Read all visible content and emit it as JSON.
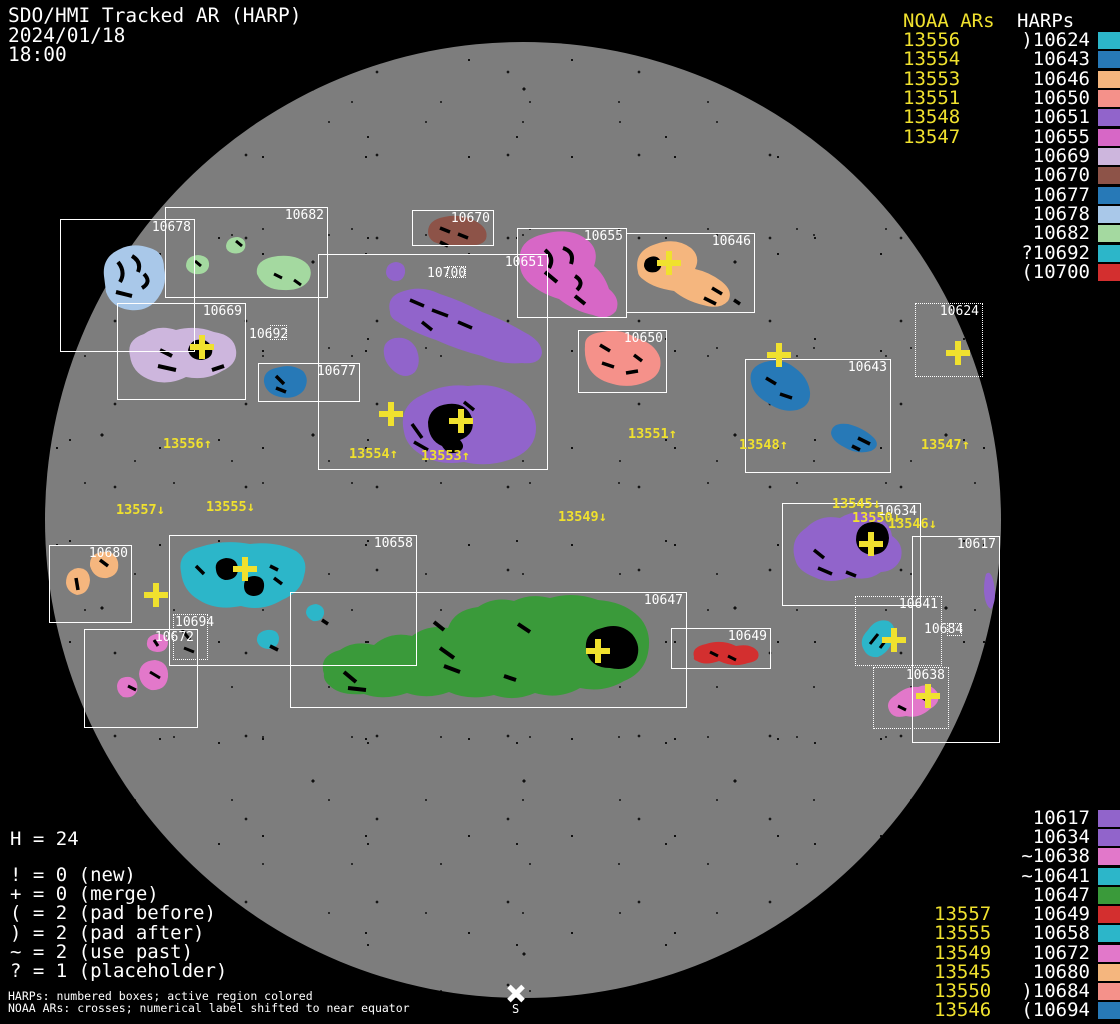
{
  "colors": {
    "yellow": "#f0e12e",
    "disk": "#7d7d7d",
    "background": "#000000",
    "box_outline": "#ffffff"
  },
  "header": {
    "title": "SDO/HMI Tracked AR (HARP)",
    "date": "2024/01/18",
    "time": "18:00"
  },
  "legend_top": {
    "noaa_header": "NOAA ARs",
    "harp_header": "HARPs",
    "rows": [
      {
        "noaa": "13556",
        "harp": ")10624",
        "color": "#2cb6c9"
      },
      {
        "noaa": "13554",
        "harp": "10643",
        "color": "#2779b7"
      },
      {
        "noaa": "13553",
        "harp": "10646",
        "color": "#f5b67e"
      },
      {
        "noaa": "13551",
        "harp": "10650",
        "color": "#f5918a"
      },
      {
        "noaa": "13548",
        "harp": "10651",
        "color": "#9164cb"
      },
      {
        "noaa": "13547",
        "harp": "10655",
        "color": "#d767c6"
      },
      {
        "noaa": "",
        "harp": "10669",
        "color": "#cdb6dd"
      },
      {
        "noaa": "",
        "harp": "10670",
        "color": "#8d5348"
      },
      {
        "noaa": "",
        "harp": "10677",
        "color": "#2779b7"
      },
      {
        "noaa": "",
        "harp": "10678",
        "color": "#a9c8e9"
      },
      {
        "noaa": "",
        "harp": "10682",
        "color": "#a4d9a0"
      },
      {
        "noaa": "",
        "harp": "?10692",
        "color": "#2cb6c9"
      },
      {
        "noaa": "",
        "harp": "(10700",
        "color": "#d32f2f"
      }
    ]
  },
  "legend_bottom": {
    "rows": [
      {
        "noaa": "",
        "harp": "10617",
        "color": "#9164cb"
      },
      {
        "noaa": "",
        "harp": "10634",
        "color": "#9164cb"
      },
      {
        "noaa": "",
        "harp": "~10638",
        "color": "#e278ca"
      },
      {
        "noaa": "",
        "harp": "~10641",
        "color": "#2cb6c9"
      },
      {
        "noaa": "",
        "harp": "10647",
        "color": "#3a9a3a"
      },
      {
        "noaa": "13557",
        "harp": "10649",
        "color": "#d32f2f"
      },
      {
        "noaa": "13555",
        "harp": "10658",
        "color": "#2cb6c9"
      },
      {
        "noaa": "13549",
        "harp": "10672",
        "color": "#e278ca"
      },
      {
        "noaa": "13545",
        "harp": "10680",
        "color": "#f5b67e"
      },
      {
        "noaa": "13550",
        "harp": ")10684",
        "color": "#f5918a"
      },
      {
        "noaa": "13546",
        "harp": "(10694",
        "color": "#2779b7"
      }
    ]
  },
  "stats": {
    "harp_count": "H = 24",
    "lines": [
      "! = 0 (new)",
      "+ = 0 (merge)",
      "( = 2 (pad before)",
      ") = 2 (pad after)",
      "~ = 2 (use past)",
      "? = 1 (placeholder)"
    ]
  },
  "caption": {
    "line1": "HARPs: numbered boxes; active region colored",
    "line2": "NOAA ARs: crosses; numerical label shifted to near equator"
  },
  "south_marker": {
    "label": "S"
  },
  "map_labels": {
    "l13556": "13556↑",
    "l13554": "13554↑",
    "l13553": "13553↑",
    "l13551": "13551↑",
    "l13548": "13548↑",
    "l13547": "13547↑",
    "l13557": "13557↓",
    "l13555": "13555↓",
    "l13549": "13549↓",
    "l13545": "13545↓",
    "l13550": "13550↓",
    "l13546": "13546↓"
  },
  "harps": {
    "h10617": {
      "label": "10617",
      "color": "#9164cb"
    },
    "h10624": {
      "label": "10624",
      "color": "#2cb6c9"
    },
    "h10634": {
      "label": "10634",
      "color": "#9164cb"
    },
    "h10638": {
      "label": "10638",
      "color": "#e278ca"
    },
    "h10641": {
      "label": "10641",
      "color": "#2cb6c9"
    },
    "h10643": {
      "label": "10643",
      "color": "#2779b7"
    },
    "h10646": {
      "label": "10646",
      "color": "#f5b67e"
    },
    "h10647": {
      "label": "10647",
      "color": "#3a9a3a"
    },
    "h10649": {
      "label": "10649",
      "color": "#d32f2f"
    },
    "h10650": {
      "label": "10650",
      "color": "#f5918a"
    },
    "h10651": {
      "label": "10651",
      "color": "#9164cb"
    },
    "h10655": {
      "label": "10655",
      "color": "#d767c6"
    },
    "h10658": {
      "label": "10658",
      "color": "#2cb6c9"
    },
    "h10669": {
      "label": "10669",
      "color": "#cdb6dd"
    },
    "h10670": {
      "label": "10670",
      "color": "#8d5348"
    },
    "h10672": {
      "label": "10672",
      "color": "#e278ca"
    },
    "h10677": {
      "label": "10677",
      "color": "#2779b7"
    },
    "h10678": {
      "label": "10678",
      "color": "#a9c8e9"
    },
    "h10680": {
      "label": "10680",
      "color": "#f5b67e"
    },
    "h10682": {
      "label": "10682",
      "color": "#a4d9a0"
    },
    "h10684": {
      "label": "10684",
      "color": "#f5918a"
    },
    "h10692": {
      "label": "10692",
      "color": "#2cb6c9"
    },
    "h10694": {
      "label": "10694",
      "color": "#2779b7"
    },
    "h10700": {
      "label": "10700",
      "color": "#d32f2f"
    }
  },
  "chart_data": {
    "type": "scatter",
    "title": "SDO/HMI Tracked AR (HARP) 2024/01/18 18:00",
    "disk_center_px": [
      523,
      520
    ],
    "disk_radius_px": 478,
    "harp_regions": [
      {
        "harp": "10678",
        "box_px": [
          60,
          219,
          135,
          133
        ],
        "outline": "solid",
        "color": "#a9c8e9"
      },
      {
        "harp": "10682",
        "box_px": [
          165,
          207,
          163,
          91
        ],
        "outline": "solid",
        "color": "#a4d9a0"
      },
      {
        "harp": "10669",
        "box_px": [
          117,
          303,
          129,
          97
        ],
        "outline": "solid",
        "color": "#cdb6dd"
      },
      {
        "harp": "10677",
        "box_px": [
          258,
          363,
          102,
          39
        ],
        "outline": "solid",
        "color": "#2779b7"
      },
      {
        "harp": "10670",
        "box_px": [
          412,
          210,
          82,
          36
        ],
        "outline": "solid",
        "color": "#8d5348"
      },
      {
        "harp": "10651",
        "box_px": [
          318,
          254,
          230,
          216
        ],
        "outline": "solid",
        "color": "#9164cb"
      },
      {
        "harp": "10655",
        "box_px": [
          517,
          228,
          110,
          90
        ],
        "outline": "solid",
        "color": "#d767c6"
      },
      {
        "harp": "10646",
        "box_px": [
          626,
          233,
          129,
          80
        ],
        "outline": "solid",
        "color": "#f5b67e"
      },
      {
        "harp": "10650",
        "box_px": [
          578,
          330,
          89,
          63
        ],
        "outline": "solid",
        "color": "#f5918a"
      },
      {
        "harp": "10643",
        "box_px": [
          745,
          359,
          146,
          114
        ],
        "outline": "solid",
        "color": "#2779b7"
      },
      {
        "harp": "10624",
        "box_px": [
          915,
          303,
          68,
          74
        ],
        "outline": "dotted",
        "color": "#2cb6c9"
      },
      {
        "harp": "10680",
        "box_px": [
          49,
          545,
          83,
          78
        ],
        "outline": "solid",
        "color": "#f5b67e"
      },
      {
        "harp": "10658",
        "box_px": [
          169,
          535,
          248,
          131
        ],
        "outline": "solid",
        "color": "#2cb6c9"
      },
      {
        "harp": "10694",
        "box_px": [
          173,
          614,
          35,
          46
        ],
        "outline": "dotted",
        "color": "#2779b7"
      },
      {
        "harp": "10672",
        "box_px": [
          84,
          629,
          114,
          99
        ],
        "outline": "solid",
        "color": "#e278ca"
      },
      {
        "harp": "10647",
        "box_px": [
          290,
          592,
          397,
          116
        ],
        "outline": "solid",
        "color": "#3a9a3a"
      },
      {
        "harp": "10649",
        "box_px": [
          671,
          628,
          100,
          41
        ],
        "outline": "solid",
        "color": "#d32f2f"
      },
      {
        "harp": "10634",
        "box_px": [
          782,
          503,
          139,
          103
        ],
        "outline": "solid",
        "color": "#9164cb"
      },
      {
        "harp": "10617",
        "box_px": [
          912,
          536,
          88,
          207
        ],
        "outline": "solid",
        "color": "#9164cb"
      },
      {
        "harp": "10641",
        "box_px": [
          855,
          596,
          87,
          70
        ],
        "outline": "dotted",
        "color": "#2cb6c9"
      },
      {
        "harp": "10638",
        "box_px": [
          873,
          667,
          76,
          62
        ],
        "outline": "dotted",
        "color": "#e278ca"
      },
      {
        "harp": "10692",
        "box_px": [
          270,
          325,
          17,
          15
        ],
        "outline": "dotted",
        "color": "#2cb6c9"
      },
      {
        "harp": "10700",
        "box_px": [
          447,
          266,
          19,
          12
        ],
        "outline": "dotted",
        "color": "#d32f2f"
      },
      {
        "harp": "10684",
        "box_px": [
          947,
          623,
          15,
          13
        ],
        "outline": "dotted",
        "color": "#f5918a"
      }
    ],
    "noaa_crosses": [
      {
        "noaa": "13556",
        "cross_px": [
          202,
          347
        ],
        "label": "13556↑",
        "label_px": [
          163,
          436
        ]
      },
      {
        "noaa": "13554",
        "cross_px": [
          391,
          414
        ],
        "label": "13554↑",
        "label_px": [
          349,
          446
        ]
      },
      {
        "noaa": "13553",
        "cross_px": [
          461,
          421
        ],
        "label": "13553↑",
        "label_px": [
          421,
          448
        ]
      },
      {
        "noaa": "13551",
        "cross_px": [
          669,
          263
        ],
        "label": "13551↑",
        "label_px": [
          628,
          426
        ]
      },
      {
        "noaa": "13548",
        "cross_px": [
          779,
          355
        ],
        "label": "13548↑",
        "label_px": [
          739,
          437
        ]
      },
      {
        "noaa": "13547",
        "cross_px": [
          958,
          353
        ],
        "label": "13547↑",
        "label_px": [
          921,
          437
        ]
      },
      {
        "noaa": "13557",
        "cross_px": [
          156,
          595
        ],
        "label": "13557↓",
        "label_px": [
          116,
          502
        ]
      },
      {
        "noaa": "13555",
        "cross_px": [
          245,
          569
        ],
        "label": "13555↓",
        "label_px": [
          206,
          499
        ]
      },
      {
        "noaa": "13549",
        "cross_px": [
          598,
          651
        ],
        "label": "13549↓",
        "label_px": [
          558,
          509
        ]
      },
      {
        "noaa": "13545",
        "cross_px": [
          871,
          544
        ],
        "label": "13545↓",
        "label_px": [
          832,
          496
        ]
      },
      {
        "noaa": "13550",
        "cross_px": [
          894,
          640
        ],
        "label": "13550↓",
        "label_px": [
          852,
          510
        ]
      },
      {
        "noaa": "13546",
        "cross_px": [
          928,
          696
        ],
        "label": "13546↓",
        "label_px": [
          888,
          516
        ]
      }
    ]
  }
}
